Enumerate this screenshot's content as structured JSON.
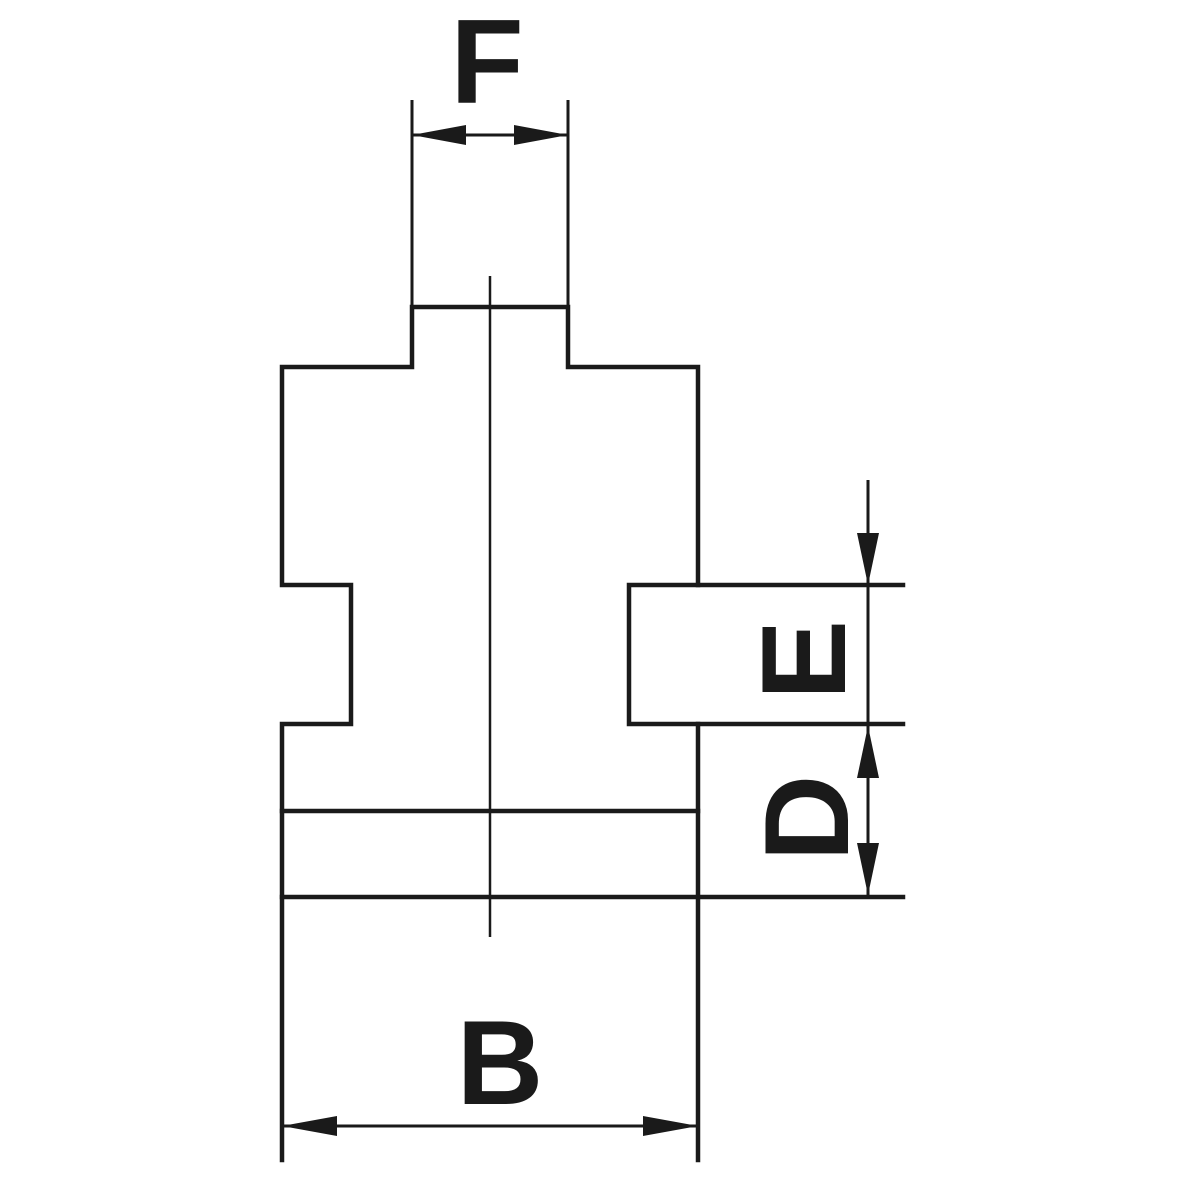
{
  "drawing": {
    "type": "technical-dimension-diagram",
    "subject": "stepped jaw cross-section profile",
    "dimensions": [
      {
        "label": "F",
        "position": "top",
        "orientation": "horizontal"
      },
      {
        "label": "E",
        "position": "right-upper",
        "orientation": "vertical"
      },
      {
        "label": "D",
        "position": "right-lower",
        "orientation": "vertical"
      },
      {
        "label": "B",
        "position": "bottom",
        "orientation": "horizontal"
      }
    ]
  },
  "colors": {
    "line": "#1a1a1a",
    "background": "#ffffff"
  }
}
